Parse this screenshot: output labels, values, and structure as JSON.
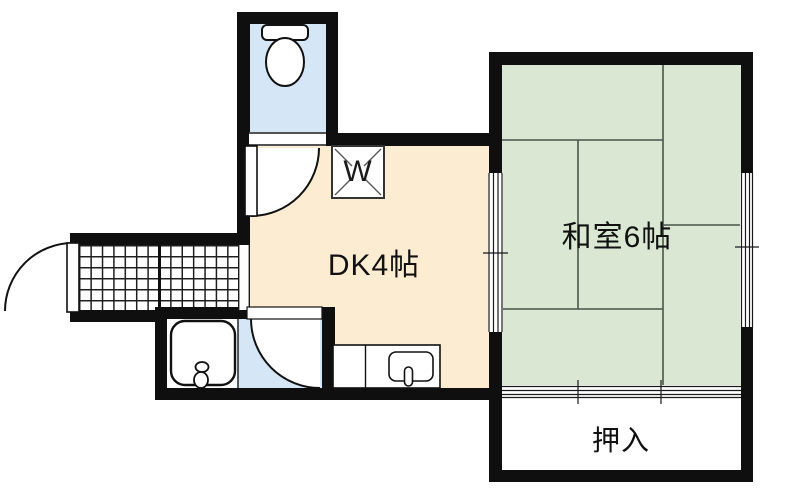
{
  "plan": {
    "title": "1DK apartment floor plan",
    "rooms": {
      "dk": {
        "label": "DK4帖",
        "floor_color": "#fcecd2"
      },
      "washitsu": {
        "label": "和室6帖",
        "floor_color": "#d9e7d3",
        "tatami_mats": 6
      },
      "oshiire": {
        "label": "押入",
        "floor_color": "#ffffff"
      },
      "toilet": {
        "floor_color": "#d5e7f7"
      },
      "bathroom": {
        "floor_color": "#d5e7f7"
      },
      "genkan": {
        "floor_pattern": "tile-grid"
      }
    },
    "fixtures": {
      "washing_machine": {
        "label": "W"
      },
      "toilet_icon": "toilet",
      "bathtub_icon": "bathtub",
      "kitchen_sink_icon": "kitchen-sink"
    },
    "colors": {
      "wall": "#0f0f0f",
      "water_blue": "#d5e7f7",
      "dk_cream": "#fcecd2",
      "tatami_green": "#d9e7d3",
      "mat_line": "#485548"
    }
  }
}
